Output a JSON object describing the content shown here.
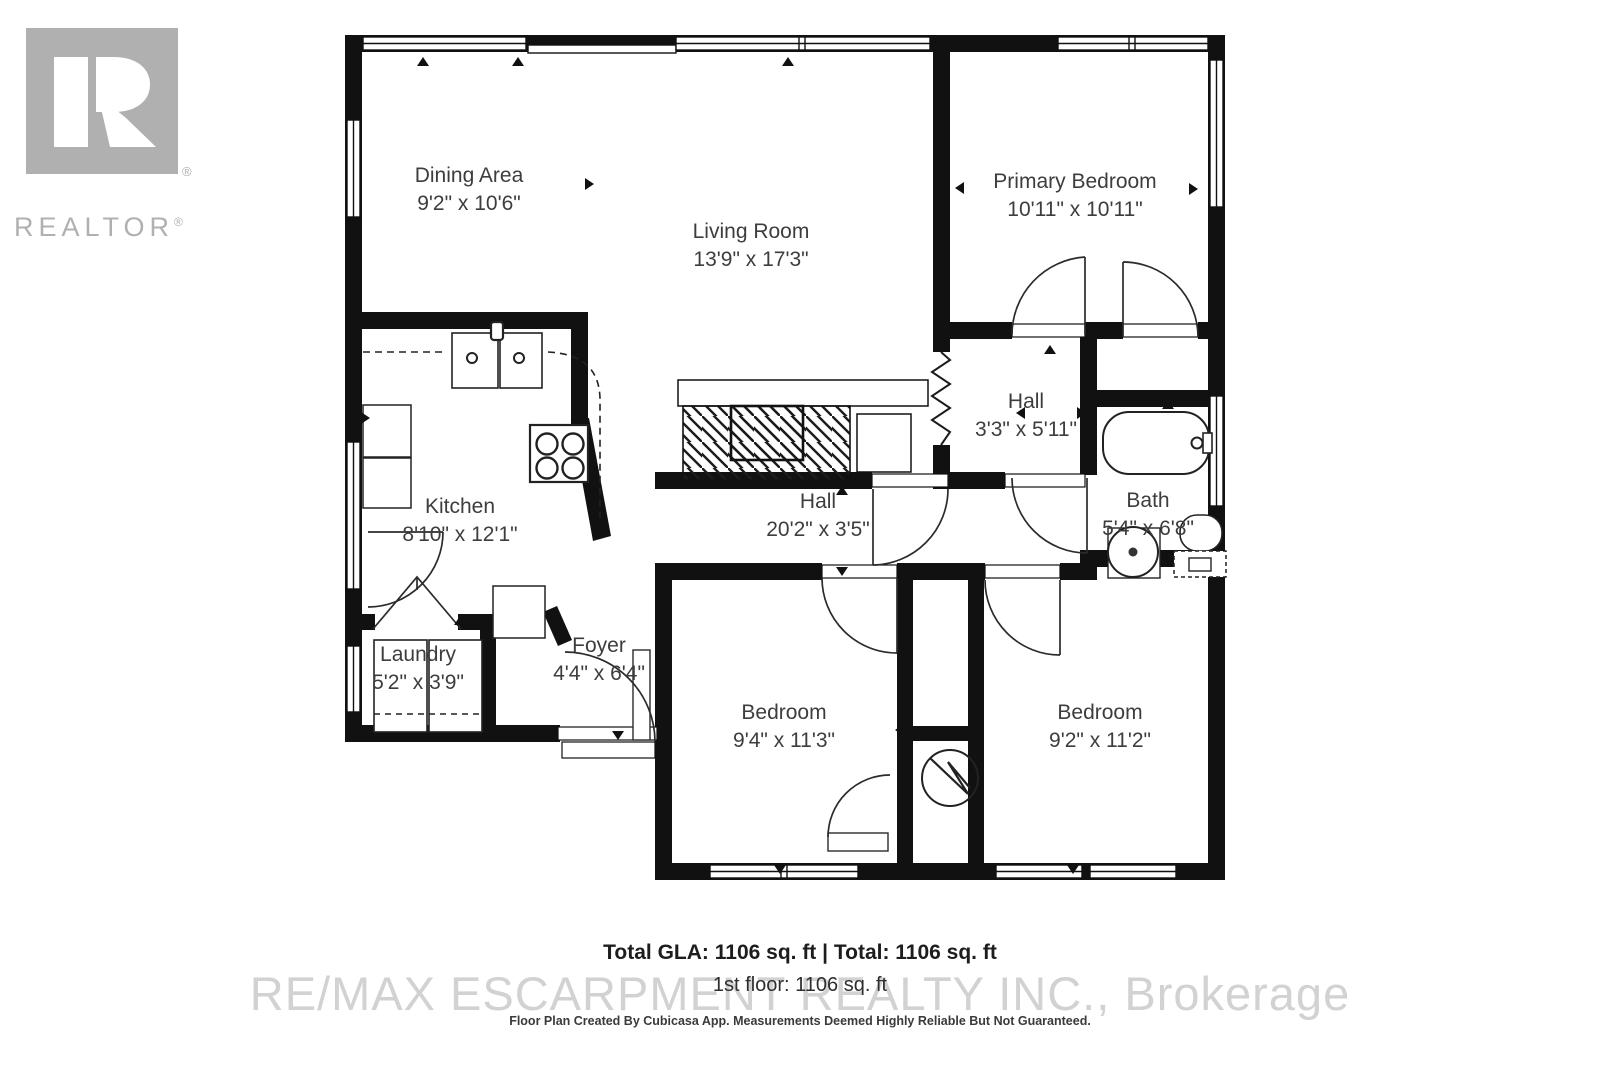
{
  "branding": {
    "logo_wordmark": "REALTOR",
    "logo_registered": "®",
    "watermark": "RE/MAX ESCARPMENT REALTY INC., Brokerage"
  },
  "rooms": [
    {
      "name": "Dining Area",
      "dims": "9'2\" x 10'6\""
    },
    {
      "name": "Living Room",
      "dims": "13'9\" x 17'3\""
    },
    {
      "name": "Primary Bedroom",
      "dims": "10'11\" x 10'11\""
    },
    {
      "name": "Hall",
      "dims": "3'3\" x 5'11\""
    },
    {
      "name": "Kitchen",
      "dims": "8'10\" x 12'1\""
    },
    {
      "name": "Hall",
      "dims": "20'2\" x 3'5\""
    },
    {
      "name": "Bath",
      "dims": "5'4\" x 6'8\""
    },
    {
      "name": "Laundry",
      "dims": "5'2\" x 3'9\""
    },
    {
      "name": "Foyer",
      "dims": "4'4\" x 6'4\""
    },
    {
      "name": "Bedroom",
      "dims": "9'4\" x 11'3\""
    },
    {
      "name": "Bedroom",
      "dims": "9'2\" x 11'2\""
    }
  ],
  "footer": {
    "totals_line": "Total GLA: 1106 sq. ft | Total: 1106 sq. ft",
    "floor_line": "1st floor: 1106 sq. ft",
    "disclaimer": "Floor Plan Created By Cubicasa App. Measurements Deemed Highly Reliable But Not Guaranteed."
  },
  "colors": {
    "wall": "#111111",
    "label_text": "#3d3d3d",
    "logo_gray": "#b0b0b0",
    "watermark_gray": "#d2d2d2"
  }
}
